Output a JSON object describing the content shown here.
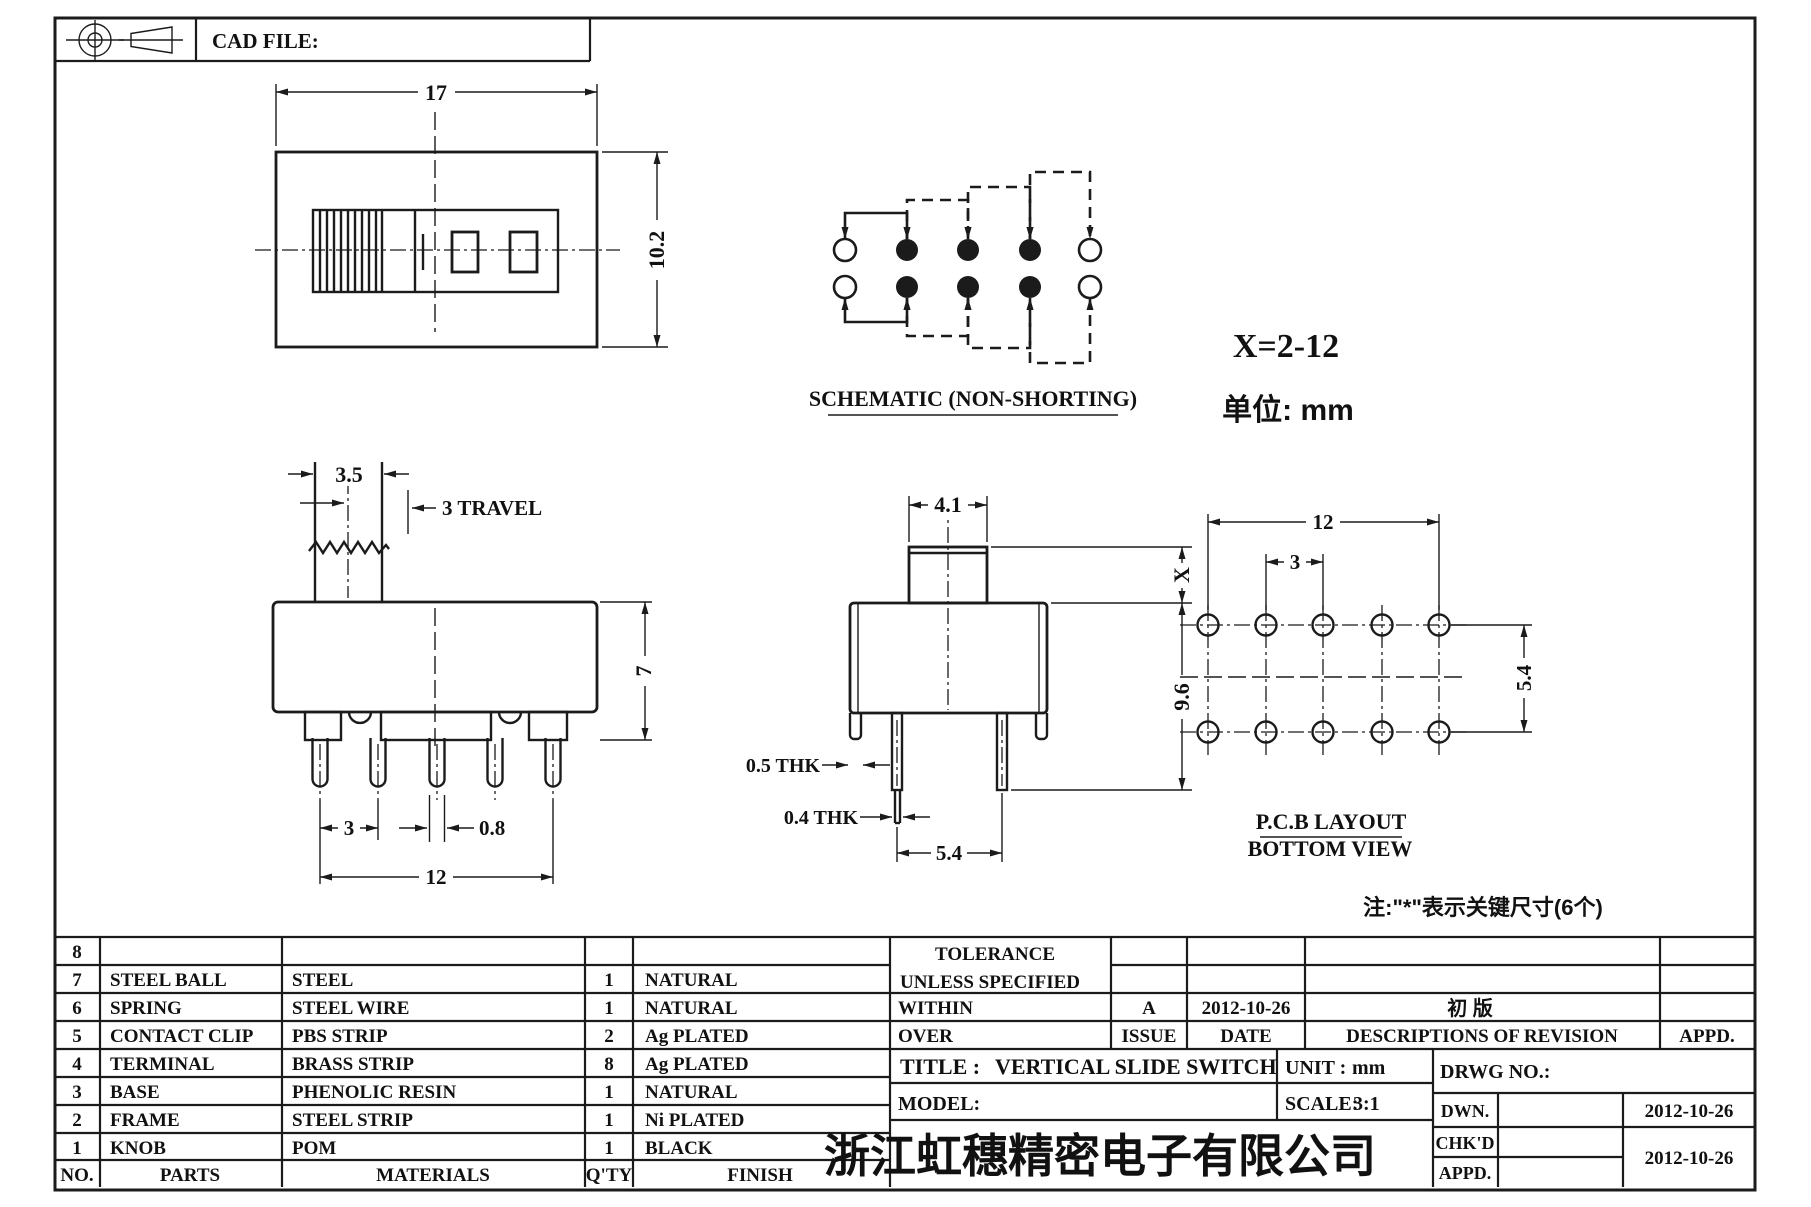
{
  "sheet": {
    "cad_file_label": "CAD FILE:"
  },
  "top_view": {
    "dim_width": "17",
    "dim_height": "10.2"
  },
  "schematic": {
    "label": "SCHEMATIC (NON-SHORTING)",
    "x_range": "X=2-12",
    "unit_note": "单位: mm"
  },
  "front_view": {
    "dim_knob_width": "3.5",
    "dim_travel": "3 TRAVEL",
    "dim_body_height": "7",
    "dim_pin_pitch": "3",
    "dim_pin_width": "0.8",
    "dim_pin_span": "12"
  },
  "side_view": {
    "dim_knob_width": "4.1",
    "dim_knob_height": "X",
    "dim_body_height": "9.6",
    "dim_frame_thk": "0.5 THK",
    "dim_pin_thk": "0.4 THK",
    "dim_row_pitch": "5.4"
  },
  "pcb_layout": {
    "label_line1": "P.C.B LAYOUT",
    "label_line2": "BOTTOM VIEW",
    "dim_span": "12",
    "dim_pitch": "3",
    "dim_row_pitch": "5.4"
  },
  "note": "注:\"*\"表示关键尺寸(6个)",
  "parts_table": {
    "headers": {
      "no": "NO.",
      "parts": "PARTS",
      "materials": "MATERIALS",
      "qty": "Q'TY",
      "finish": "FINISH"
    },
    "rows": [
      {
        "no": "8",
        "part": "",
        "material": "",
        "qty": "",
        "finish": ""
      },
      {
        "no": "7",
        "part": "STEEL BALL",
        "material": "STEEL",
        "qty": "1",
        "finish": "NATURAL"
      },
      {
        "no": "6",
        "part": "SPRING",
        "material": "STEEL WIRE",
        "qty": "1",
        "finish": "NATURAL"
      },
      {
        "no": "5",
        "part": "CONTACT CLIP",
        "material": "PBS STRIP",
        "qty": "2",
        "finish": "Ag PLATED"
      },
      {
        "no": "4",
        "part": "TERMINAL",
        "material": "BRASS STRIP",
        "qty": "8",
        "finish": "Ag PLATED"
      },
      {
        "no": "3",
        "part": "BASE",
        "material": "PHENOLIC RESIN",
        "qty": "1",
        "finish": "NATURAL"
      },
      {
        "no": "2",
        "part": "FRAME",
        "material": "STEEL STRIP",
        "qty": "1",
        "finish": "Ni PLATED"
      },
      {
        "no": "1",
        "part": "KNOB",
        "material": "POM",
        "qty": "1",
        "finish": "BLACK"
      }
    ]
  },
  "title_block": {
    "tolerance_line1": "TOLERANCE",
    "tolerance_line2": "UNLESS  SPECIFIED",
    "within_label": "WITHIN",
    "over_label": "OVER",
    "issue_value": "A",
    "issue_date": "2012-10-26",
    "revision_desc": "初  版",
    "issue_label": "ISSUE",
    "date_label": "DATE",
    "descriptions_label": "DESCRIPTIONS OF REVISION",
    "appd_col_label": "APPD.",
    "title_label": "TITLE :",
    "title_value": "VERTICAL SLIDE SWITCH",
    "unit_label": "UNIT :",
    "unit_value": "mm",
    "model_label": "MODEL:",
    "scale_label": "SCALE:",
    "scale_value": "3:1",
    "drwg_label": "DRWG NO.:",
    "dwn_label": "DWN.",
    "dwn_date": "2012-10-26",
    "chkd_label": "CHK'D",
    "appd_label": "APPD.",
    "chkd_date": "2012-10-26",
    "company": "浙江虹穗精密电子有限公司"
  }
}
